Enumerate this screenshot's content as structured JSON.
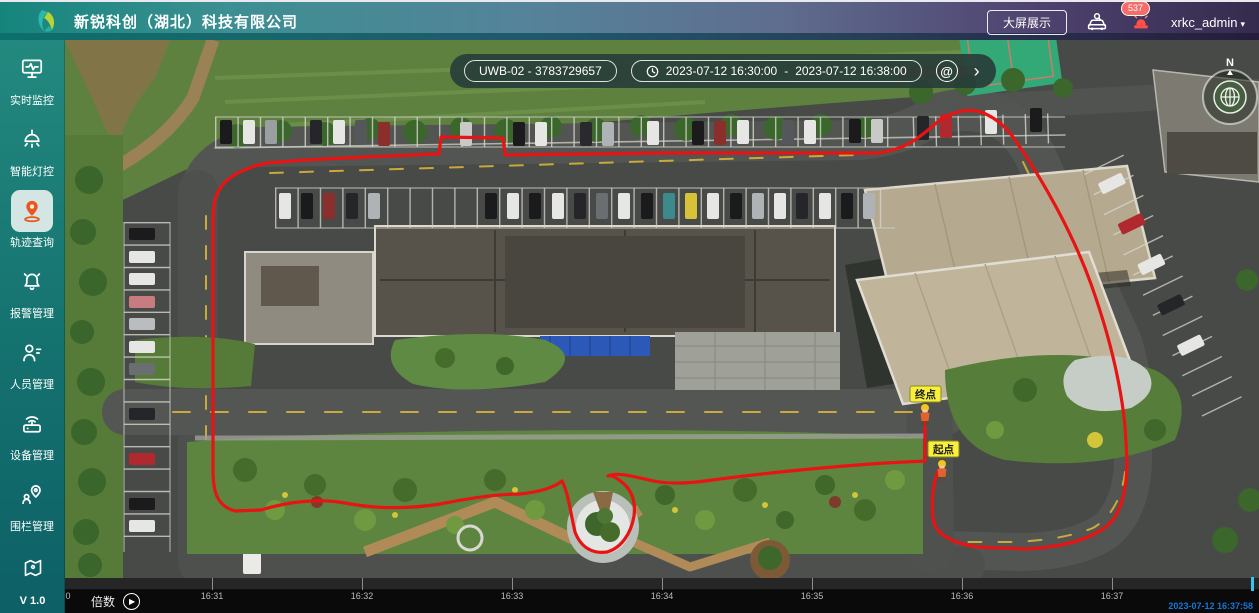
{
  "header": {
    "title": "新锐科创（湖北）科技有限公司",
    "big_screen_button": "大屏展示",
    "alarm_badge": "537",
    "username": "xrkc_admin",
    "caret_icon": "▾"
  },
  "sidebar": {
    "items": [
      {
        "label": "实时监控"
      },
      {
        "label": "智能灯控"
      },
      {
        "label": "轨迹查询"
      },
      {
        "label": "报警管理"
      },
      {
        "label": "人员管理"
      },
      {
        "label": "设备管理"
      },
      {
        "label": "围栏管理"
      }
    ],
    "version": "V 1.0"
  },
  "map": {
    "toolbar": {
      "device": "UWB-02 - 3783729657",
      "time_start": "2023-07-12 16:30:00",
      "separator": "-",
      "time_end": "2023-07-12 16:38:00",
      "search_icon": "@",
      "chevron_icon": "›"
    },
    "current_position": "当前位置：张三",
    "markers": {
      "end": "终点",
      "start": "起点"
    },
    "compass_label": "N"
  },
  "timeline": {
    "speed_label": "倍数",
    "play_icon": "▶",
    "edge_tick": "0",
    "ticks": [
      "16:31",
      "16:32",
      "16:33",
      "16:34",
      "16:35",
      "16:36",
      "16:37"
    ],
    "current_time": "2023-07-12 16:37:58"
  },
  "colors": {
    "trajectory_red": "#e81313",
    "selected_icon_orange": "#e8571f",
    "header_teal": "#15857c",
    "header_purple": "#352b4e",
    "playhead_cyan": "#35c5f0",
    "timestamp_blue": "#1677d9",
    "marker_yellow": "#f8ef3a"
  }
}
